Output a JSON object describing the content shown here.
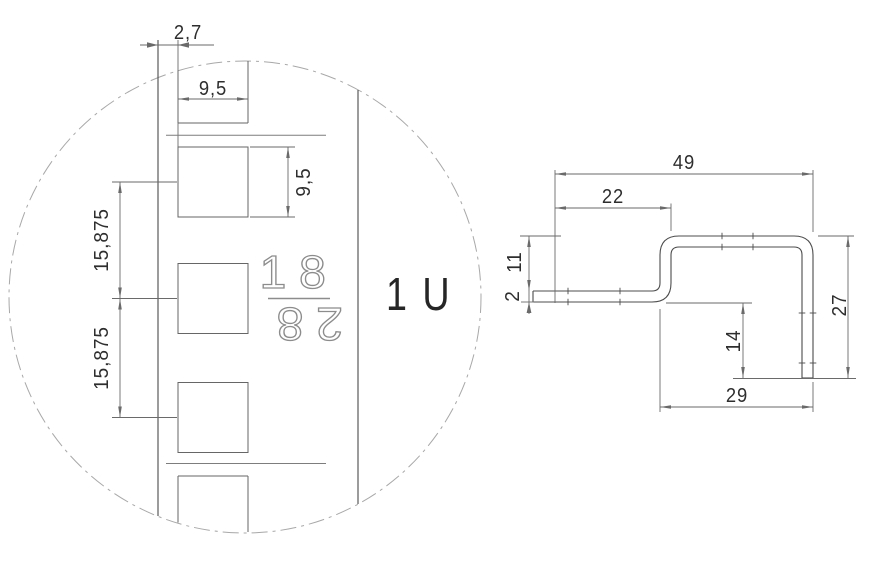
{
  "title": "Rack rail technical drawing",
  "detail_view": {
    "unit_label": "1 U",
    "stamp": {
      "top": "18",
      "bottom": "28"
    },
    "dimensions": {
      "edge_offset": "2,7",
      "hole_width": "9,5",
      "hole_height": "9,5",
      "hole_pitch_upper": "15,875",
      "hole_pitch_lower": "15,875"
    }
  },
  "profile_view": {
    "dimensions": {
      "overall_width": "49",
      "step_offset": "22",
      "step_height": "11",
      "material_thickness": "2",
      "leg_below_flange": "14",
      "overall_height": "27",
      "bottom_width": "29"
    }
  },
  "colors": {
    "line": "#4c4c4c",
    "square": "#666666",
    "dim": "#6a6a6a",
    "centerline": "#a8a8a8",
    "text": "#2e2e2e",
    "stamp": "#8c8c8c",
    "sep": "#7d7d7d",
    "bg": "#ffffff"
  }
}
